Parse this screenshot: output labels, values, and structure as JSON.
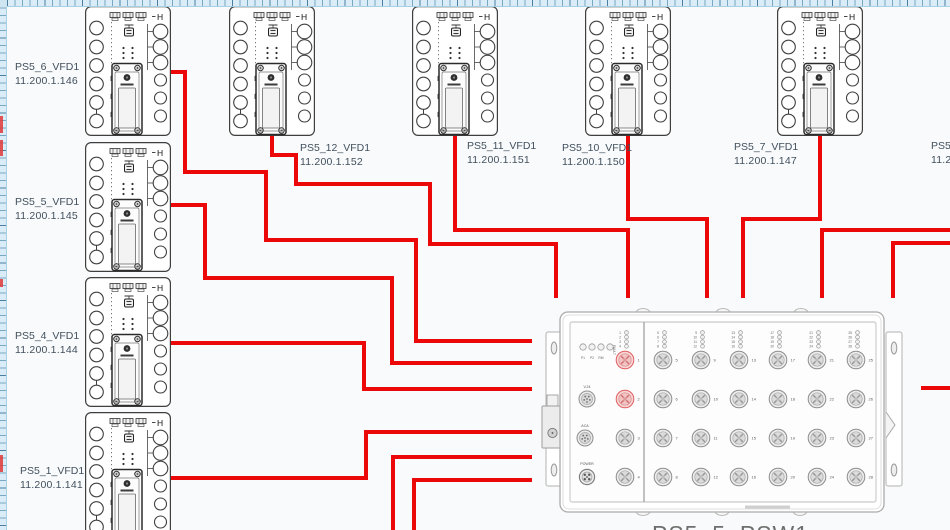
{
  "colors": {
    "wire": "#ec0808",
    "canvas": "#f8fafb",
    "label_text": "#42505e",
    "device_line": "#3f3f3f",
    "switch_line": "#ababab",
    "port_highlight": "#df5f5f"
  },
  "devices": [
    {
      "name": "PS5_6_VFD1",
      "ip": "11.200.1.146",
      "x": 85,
      "y": 6,
      "label_x": 15,
      "label_y": 60
    },
    {
      "name": "PS5_5_VFD1",
      "ip": "11.200.1.145",
      "x": 85,
      "y": 142,
      "label_x": 15,
      "label_y": 195
    },
    {
      "name": "PS5_4_VFD1",
      "ip": "11.200.1.144",
      "x": 85,
      "y": 277,
      "label_x": 15,
      "label_y": 329
    },
    {
      "name": "PS5_1_VFD1",
      "ip": "11.200.1.141",
      "x": 85,
      "y": 412,
      "label_x": 20,
      "label_y": 464
    },
    {
      "name": "PS5_12_VFD1",
      "ip": "11.200.1.152",
      "x": 229,
      "y": 6,
      "label_x": 300,
      "label_y": 141
    },
    {
      "name": "PS5_11_VFD1",
      "ip": "11.200.1.151",
      "x": 412,
      "y": 6,
      "label_x": 467,
      "label_y": 139
    },
    {
      "name": "PS5_10_VFD1",
      "ip": "11.200.1.150",
      "x": 585,
      "y": 6,
      "label_x": 562,
      "label_y": 141
    },
    {
      "name": "PS5_7_VFD1",
      "ip": "11.200.1.147",
      "x": 777,
      "y": 6,
      "label_x": 734,
      "label_y": 140
    },
    {
      "name": "PS5_8",
      "ip": "11.200.1",
      "x": null,
      "y": null,
      "label_x": 931,
      "label_y": 139
    }
  ],
  "wires": [
    {
      "from": "PS5_6_VFD1",
      "points": [
        [
          171,
          72
        ],
        [
          185,
          72
        ],
        [
          185,
          172
        ],
        [
          266,
          172
        ],
        [
          266,
          240
        ],
        [
          416,
          240
        ],
        [
          416,
          341
        ],
        [
          532,
          341
        ]
      ]
    },
    {
      "from": "PS5_5_VFD1",
      "points": [
        [
          171,
          205
        ],
        [
          205,
          205
        ],
        [
          205,
          278
        ],
        [
          392,
          278
        ],
        [
          392,
          363
        ],
        [
          532,
          363
        ]
      ]
    },
    {
      "from": "PS5_4_VFD1",
      "points": [
        [
          171,
          343
        ],
        [
          364,
          343
        ],
        [
          364,
          389
        ],
        [
          532,
          389
        ]
      ]
    },
    {
      "from": "PS5_1_VFD1",
      "points": [
        [
          171,
          478
        ],
        [
          366,
          478
        ],
        [
          366,
          432
        ],
        [
          532,
          432
        ]
      ]
    },
    {
      "from": "offscreen-bottom-1",
      "points": [
        [
          393,
          532
        ],
        [
          393,
          457
        ],
        [
          532,
          457
        ]
      ]
    },
    {
      "from": "offscreen-bottom-2",
      "points": [
        [
          414,
          532
        ],
        [
          414,
          480
        ],
        [
          532,
          480
        ]
      ]
    },
    {
      "from": "PS5_12_VFD1",
      "points": [
        [
          272,
          134
        ],
        [
          272,
          155
        ],
        [
          296,
          155
        ],
        [
          296,
          184
        ],
        [
          430,
          184
        ],
        [
          430,
          244
        ],
        [
          556,
          244
        ],
        [
          556,
          298
        ]
      ]
    },
    {
      "from": "PS5_11_VFD1",
      "points": [
        [
          455,
          134
        ],
        [
          455,
          230
        ],
        [
          628,
          230
        ],
        [
          628,
          298
        ]
      ]
    },
    {
      "from": "PS5_10_VFD1",
      "points": [
        [
          628,
          134
        ],
        [
          628,
          219
        ],
        [
          707,
          219
        ],
        [
          707,
          298
        ]
      ]
    },
    {
      "from": "PS5_7_VFD1",
      "points": [
        [
          820,
          134
        ],
        [
          820,
          219
        ],
        [
          743,
          219
        ],
        [
          743,
          298
        ]
      ]
    },
    {
      "from": "offscreen-right-1",
      "points": [
        [
          951,
          230
        ],
        [
          822,
          230
        ],
        [
          822,
          298
        ]
      ]
    },
    {
      "from": "offscreen-right-2",
      "points": [
        [
          951,
          243
        ],
        [
          893,
          243
        ],
        [
          893,
          298
        ]
      ]
    },
    {
      "from": "offscreen-right-3",
      "points": [
        [
          951,
          388
        ],
        [
          921,
          388
        ]
      ]
    }
  ],
  "switch": {
    "name": "PS5_5_PSW1",
    "status_leds": [
      "P1",
      "P2",
      "RM",
      "FAULT"
    ],
    "side_ports": [
      "V.24",
      "ACA",
      "POWER"
    ],
    "ports_total": 28,
    "port_rows": 4,
    "port_cols": 7,
    "highlighted_ports": [
      1,
      2
    ]
  }
}
